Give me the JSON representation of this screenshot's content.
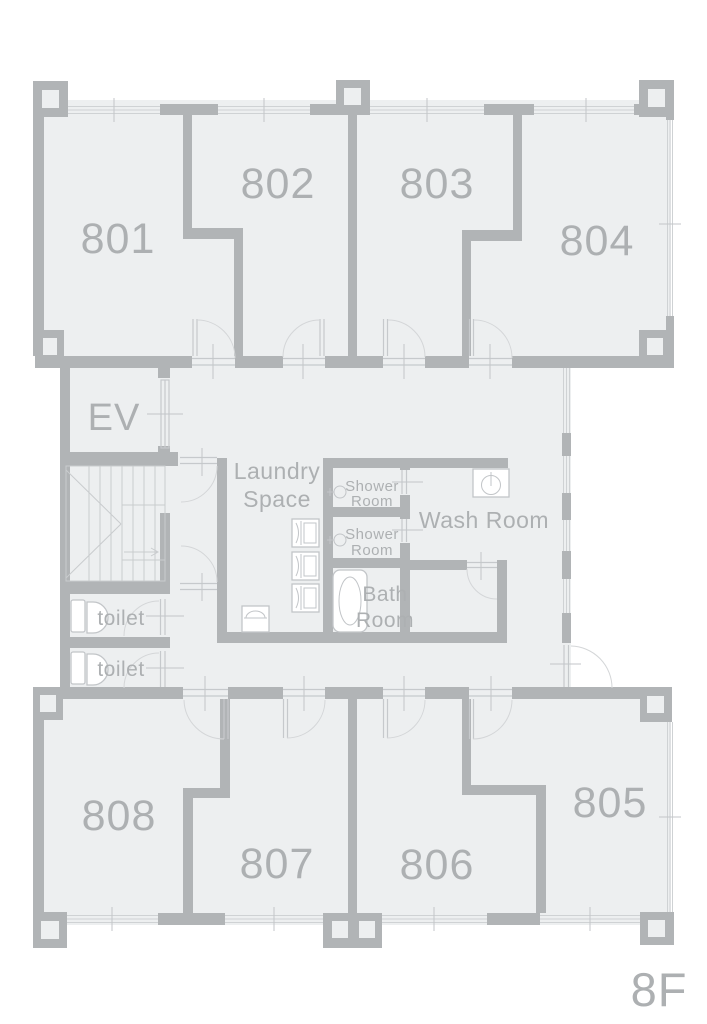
{
  "floor_plan": {
    "floor_label": "8F",
    "rooms": {
      "r801": "801",
      "r802": "802",
      "r803": "803",
      "r804": "804",
      "r805": "805",
      "r806": "806",
      "r807": "807",
      "r808": "808"
    },
    "facilities": {
      "elevator": "EV",
      "laundry_line1": "Laundry",
      "laundry_line2": "Space",
      "shower1_line1": "Shower",
      "shower1_line2": "Room",
      "shower2_line1": "Shower",
      "shower2_line2": "Room",
      "wash_room": "Wash Room",
      "bath_line1": "Bath",
      "bath_line2": "Room",
      "toilet1": "toilet",
      "toilet2": "toilet"
    },
    "colors": {
      "wall": "#b1b4b6",
      "room_fill": "#edeff0",
      "line": "#c9ccce",
      "text": "#adb0b2",
      "background": "#ffffff"
    }
  }
}
